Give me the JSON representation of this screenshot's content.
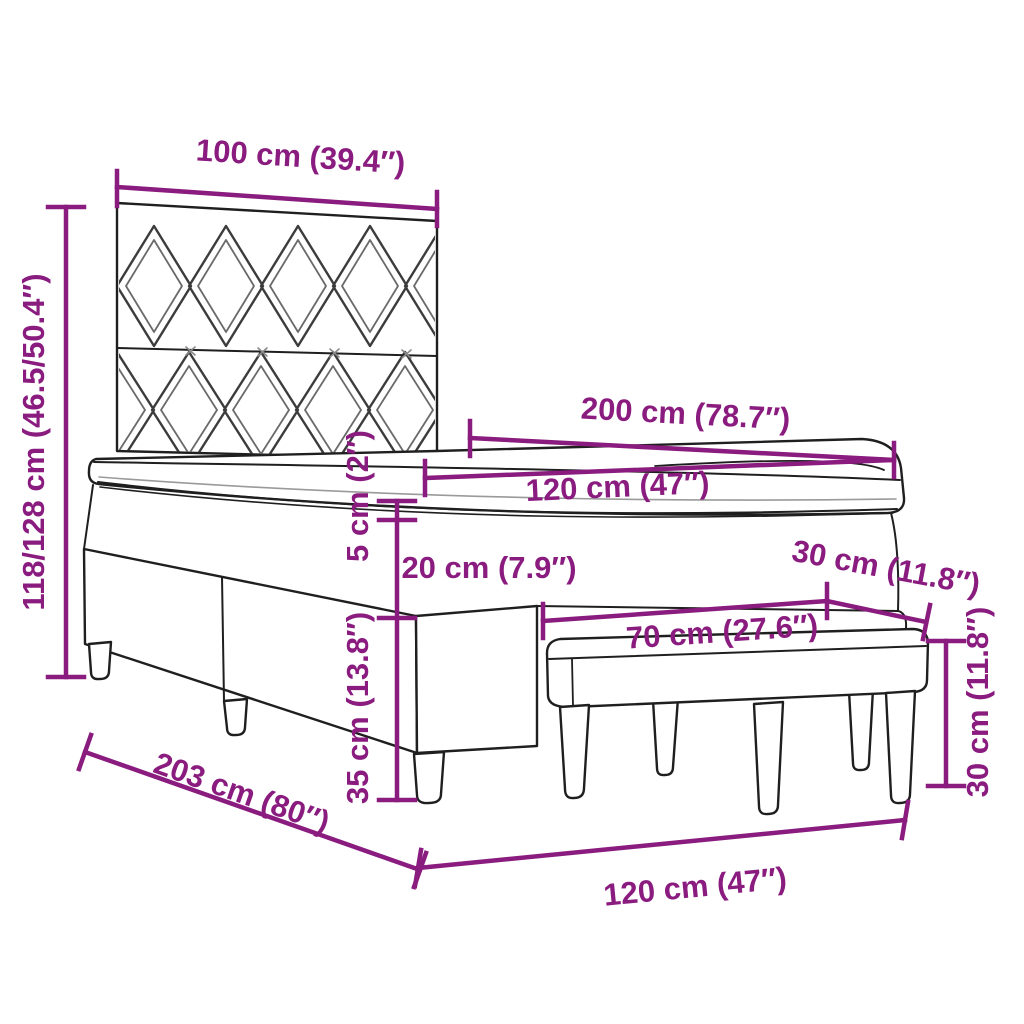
{
  "diagram_title": "box-spring-bed-with-bench-dimension-diagram",
  "labels": {
    "headboard_width": "100 cm (39.4″)",
    "total_height": "118/128 cm (46.5/50.4″)",
    "bed_length": "200 cm (78.7″)",
    "mattress_width": "120 cm (47″)",
    "topper_thickness": "5 cm (2″)",
    "mattress_thickness": "20 cm (7.9″)",
    "base_height": "35 cm (13.8″)",
    "frame_length": "203 cm (80″)",
    "frame_width": "120 cm (47″)",
    "bench_length": "70 cm (27.6″)",
    "bench_depth": "30 cm (11.8″)",
    "bench_height": "30 cm (11.8″)"
  },
  "colors": {
    "dimension": "#8a1b7f",
    "outline": "#1f1f1f",
    "pattern": "#3c3c3c",
    "background": "#ffffff"
  }
}
